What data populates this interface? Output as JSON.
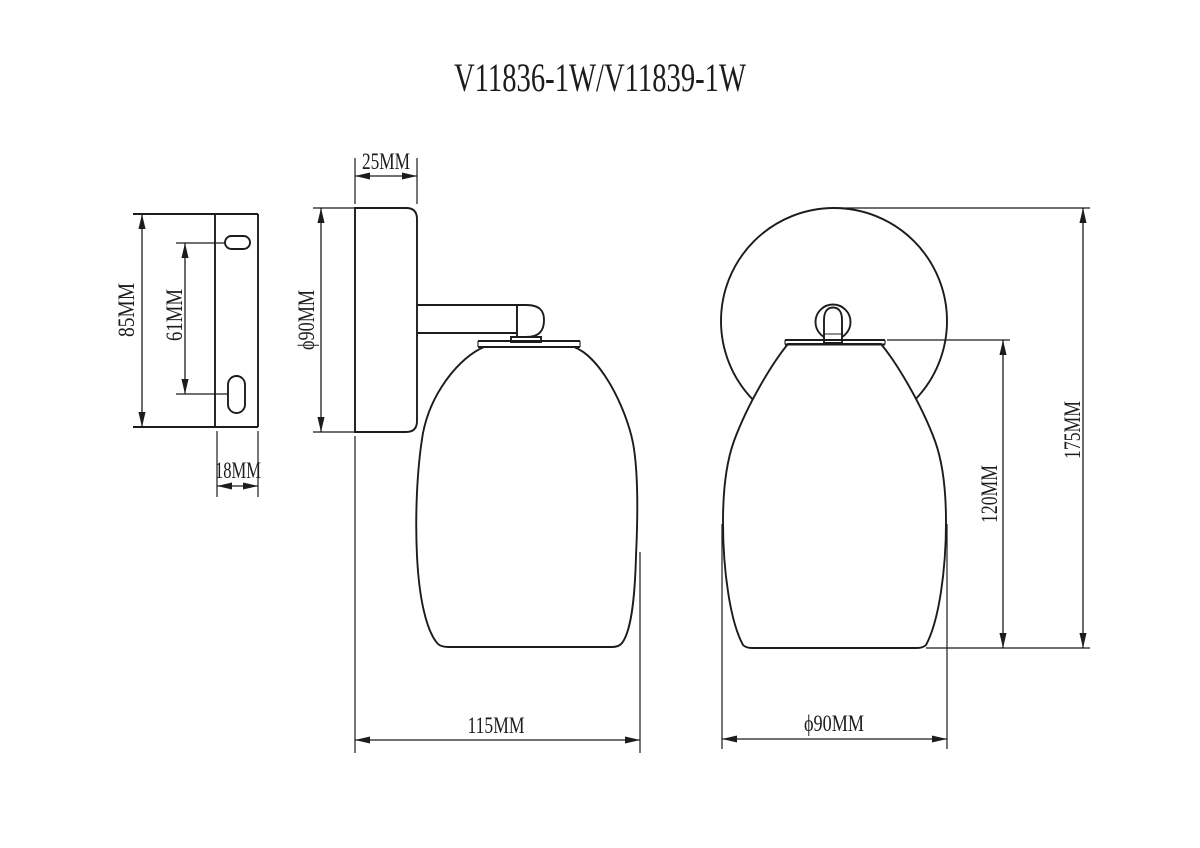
{
  "title": "V11836-1W/V11839-1W",
  "views": {
    "bracket_side": {
      "height": "85MM",
      "slot_spacing": "61MM",
      "depth": "18MM"
    },
    "lamp_side": {
      "canopy_depth": "25MM",
      "canopy_diameter": "ϕ90MM",
      "projection": "115MM"
    },
    "lamp_front": {
      "overall_height": "175MM",
      "shade_height": "120MM",
      "shade_diameter": "ϕ90MM"
    }
  },
  "colors": {
    "line": "#1c1c1c",
    "background": "#ffffff"
  }
}
